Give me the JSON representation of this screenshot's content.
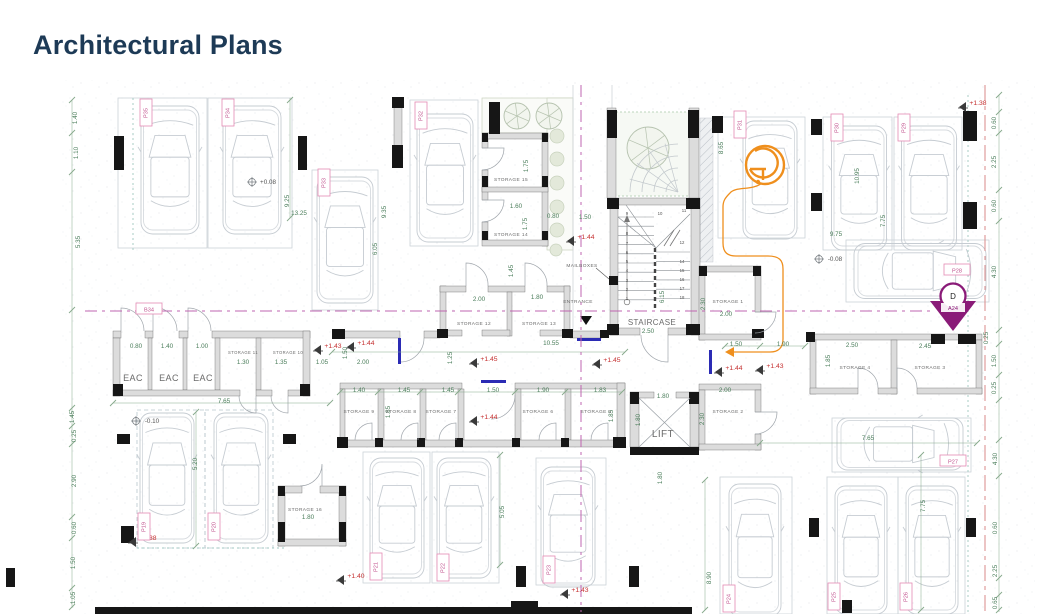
{
  "page": {
    "title": "Architectural Plans"
  },
  "colors": {
    "title": "#1d3a56",
    "dim": "#4a7d5a",
    "level": "#c53030",
    "spot": "#6f757a",
    "parking_border": "#e48ab4",
    "parking_text": "#c2548f",
    "wall_black": "#161616",
    "wall_gray": "#dcdcdc",
    "door": "#a0a6ac",
    "orange": "#ef8f1d",
    "marker_purple": "#8a1b78",
    "centerline": "#bf64b0",
    "boundary_red": "#d98a8a",
    "teal": "#9fc7c0",
    "blue_door": "#2b2bb4",
    "car": "#c6ccd2",
    "room_text": "#6a6a6a",
    "chain": "#86a98b"
  },
  "plan": {
    "rooms": [
      {
        "t": "STORAGE 15",
        "x": 511,
        "y": 181,
        "s": 4.8
      },
      {
        "t": "STORAGE 14",
        "x": 511,
        "y": 236,
        "s": 4.8
      },
      {
        "t": "STORAGE 13",
        "x": 539,
        "y": 325,
        "s": 4.8
      },
      {
        "t": "STORAGE 12",
        "x": 474,
        "y": 325,
        "s": 4.8
      },
      {
        "t": "STORAGE 11",
        "x": 243,
        "y": 354,
        "s": 4.2
      },
      {
        "t": "STORAGE 10",
        "x": 288,
        "y": 354,
        "s": 4.2
      },
      {
        "t": "STORAGE 9",
        "x": 359,
        "y": 413,
        "s": 4.8
      },
      {
        "t": "STORAGE 8",
        "x": 401,
        "y": 413,
        "s": 4.8
      },
      {
        "t": "STORAGE 7",
        "x": 441,
        "y": 413,
        "s": 4.8
      },
      {
        "t": "STORAGE 6",
        "x": 538,
        "y": 413,
        "s": 4.8
      },
      {
        "t": "STORAGE 5",
        "x": 596,
        "y": 413,
        "s": 4.8
      },
      {
        "t": "STORAGE 4",
        "x": 855,
        "y": 369,
        "s": 4.8
      },
      {
        "t": "STORAGE 3",
        "x": 930,
        "y": 369,
        "s": 4.8
      },
      {
        "t": "STORAGE 2",
        "x": 728,
        "y": 413,
        "s": 4.8
      },
      {
        "t": "STORAGE 1",
        "x": 728,
        "y": 303,
        "s": 4.8
      },
      {
        "t": "STORAGE 16",
        "x": 305,
        "y": 511,
        "s": 4.8
      },
      {
        "t": "EAC",
        "x": 133,
        "y": 381,
        "s": 9
      },
      {
        "t": "EAC",
        "x": 169,
        "y": 381,
        "s": 9
      },
      {
        "t": "EAC",
        "x": 203,
        "y": 381,
        "s": 9
      },
      {
        "t": "LIFT",
        "x": 663,
        "y": 437,
        "s": 10
      },
      {
        "t": "STAIRCASE",
        "x": 652,
        "y": 325,
        "s": 8
      },
      {
        "t": "ENTRANCE",
        "x": 578,
        "y": 303,
        "s": 4.8
      },
      {
        "t": "MAILBOXES",
        "x": 582,
        "y": 267,
        "s": 4.8
      }
    ],
    "dims": [
      {
        "t": "1.40",
        "x": 77,
        "y": 118,
        "v": 1
      },
      {
        "t": "1.10",
        "x": 78,
        "y": 153,
        "v": 1
      },
      {
        "t": "5.35",
        "x": 80,
        "y": 242,
        "v": 1
      },
      {
        "t": "1.45",
        "x": 74,
        "y": 417,
        "v": 1
      },
      {
        "t": "0.25",
        "x": 76,
        "y": 436,
        "v": 1
      },
      {
        "t": "2.90",
        "x": 76,
        "y": 481,
        "v": 1
      },
      {
        "t": "0.60",
        "x": 76,
        "y": 528,
        "v": 1
      },
      {
        "t": "1.50",
        "x": 75,
        "y": 563,
        "v": 1
      },
      {
        "t": "1.05",
        "x": 75,
        "y": 598,
        "v": 1
      },
      {
        "t": "9.25",
        "x": 289,
        "y": 201,
        "v": 1
      },
      {
        "t": "13.25",
        "x": 299,
        "y": 215,
        "v": 0
      },
      {
        "t": "9.35",
        "x": 386,
        "y": 212,
        "v": 1
      },
      {
        "t": "6.05",
        "x": 377,
        "y": 249,
        "v": 1
      },
      {
        "t": "8.65",
        "x": 723,
        "y": 148,
        "v": 1
      },
      {
        "t": "10.95",
        "x": 859,
        "y": 176,
        "v": 1
      },
      {
        "t": "7.75",
        "x": 885,
        "y": 221,
        "v": 1
      },
      {
        "t": "9.75",
        "x": 836,
        "y": 236,
        "v": 0
      },
      {
        "t": "2.00",
        "x": 363,
        "y": 364,
        "v": 0
      },
      {
        "t": "1.50",
        "x": 347,
        "y": 353,
        "v": 1
      },
      {
        "t": "1.25",
        "x": 452,
        "y": 358,
        "v": 1
      },
      {
        "t": "10.55",
        "x": 551,
        "y": 345,
        "v": 0
      },
      {
        "t": "1.50",
        "x": 736,
        "y": 346,
        "v": 0
      },
      {
        "t": "1.90",
        "x": 783,
        "y": 346,
        "v": 0
      },
      {
        "t": "1.40",
        "x": 359,
        "y": 392,
        "v": 0
      },
      {
        "t": "1.45",
        "x": 404,
        "y": 392,
        "v": 0
      },
      {
        "t": "1.45",
        "x": 448,
        "y": 392,
        "v": 0
      },
      {
        "t": "1.50",
        "x": 493,
        "y": 392,
        "v": 0
      },
      {
        "t": "1.90",
        "x": 543,
        "y": 392,
        "v": 0
      },
      {
        "t": "1.83",
        "x": 600,
        "y": 392,
        "v": 0
      },
      {
        "t": "1.85",
        "x": 390,
        "y": 412,
        "v": 1
      },
      {
        "t": "1.85",
        "x": 613,
        "y": 416,
        "v": 1
      },
      {
        "t": "0.80",
        "x": 136,
        "y": 348,
        "v": 0
      },
      {
        "t": "1.40",
        "x": 167,
        "y": 348,
        "v": 0
      },
      {
        "t": "1.00",
        "x": 202,
        "y": 348,
        "v": 0
      },
      {
        "t": "1.30",
        "x": 243,
        "y": 364,
        "v": 0
      },
      {
        "t": "1.35",
        "x": 281,
        "y": 364,
        "v": 0
      },
      {
        "t": "1.05",
        "x": 322,
        "y": 364,
        "v": 0
      },
      {
        "t": "7.65",
        "x": 224,
        "y": 403,
        "v": 0
      },
      {
        "t": "5.20",
        "x": 197,
        "y": 464,
        "v": 1
      },
      {
        "t": "1.75",
        "x": 528,
        "y": 166,
        "v": 1
      },
      {
        "t": "1.60",
        "x": 516,
        "y": 208,
        "v": 0
      },
      {
        "t": "1.75",
        "x": 527,
        "y": 224,
        "v": 1
      },
      {
        "t": "0.80",
        "x": 553,
        "y": 218,
        "v": 0
      },
      {
        "t": "1.50",
        "x": 585,
        "y": 219,
        "v": 0
      },
      {
        "t": "1.45",
        "x": 513,
        "y": 271,
        "v": 1
      },
      {
        "t": "1.80",
        "x": 537,
        "y": 299,
        "v": 0
      },
      {
        "t": "2.00",
        "x": 479,
        "y": 301,
        "v": 0
      },
      {
        "t": "2.00",
        "x": 726,
        "y": 316,
        "v": 0
      },
      {
        "t": "2.30",
        "x": 705,
        "y": 304,
        "v": 1
      },
      {
        "t": "2.00",
        "x": 725,
        "y": 392,
        "v": 0
      },
      {
        "t": "2.30",
        "x": 704,
        "y": 419,
        "v": 1
      },
      {
        "t": "1.80",
        "x": 663,
        "y": 398,
        "v": 0
      },
      {
        "t": "1.80",
        "x": 640,
        "y": 420,
        "v": 1
      },
      {
        "t": "1.80",
        "x": 662,
        "y": 478,
        "v": 1
      },
      {
        "t": "2.50",
        "x": 852,
        "y": 347,
        "v": 0
      },
      {
        "t": "1.85",
        "x": 830,
        "y": 361,
        "v": 1
      },
      {
        "t": "2.45",
        "x": 925,
        "y": 348,
        "v": 0
      },
      {
        "t": "2.50",
        "x": 648,
        "y": 333,
        "v": 0
      },
      {
        "t": "6.15",
        "x": 664,
        "y": 297,
        "v": 1
      },
      {
        "t": "1.80",
        "x": 308,
        "y": 519,
        "v": 0
      },
      {
        "t": "0.60",
        "x": 996,
        "y": 123,
        "v": 1
      },
      {
        "t": "2.25",
        "x": 996,
        "y": 162,
        "v": 1
      },
      {
        "t": "0.60",
        "x": 996,
        "y": 206,
        "v": 1
      },
      {
        "t": "4.30",
        "x": 996,
        "y": 272,
        "v": 1
      },
      {
        "t": "0.25",
        "x": 988,
        "y": 338,
        "v": 1
      },
      {
        "t": "1.50",
        "x": 996,
        "y": 361,
        "v": 1
      },
      {
        "t": "0.25",
        "x": 996,
        "y": 388,
        "v": 1
      },
      {
        "t": "4.30",
        "x": 997,
        "y": 459,
        "v": 1
      },
      {
        "t": "0.60",
        "x": 997,
        "y": 528,
        "v": 1
      },
      {
        "t": "2.25",
        "x": 997,
        "y": 571,
        "v": 1
      },
      {
        "t": "0.65",
        "x": 997,
        "y": 603,
        "v": 1
      },
      {
        "t": "7.65",
        "x": 868,
        "y": 440,
        "v": 0
      },
      {
        "t": "7.75",
        "x": 925,
        "y": 506,
        "v": 1
      },
      {
        "t": "8.90",
        "x": 711,
        "y": 578,
        "v": 1
      },
      {
        "t": "5.05",
        "x": 504,
        "y": 512,
        "v": 1
      }
    ],
    "levels": [
      {
        "t": "+1.44",
        "x": 366,
        "y": 345
      },
      {
        "t": "+1.43",
        "x": 333,
        "y": 348
      },
      {
        "t": "+1.45",
        "x": 489,
        "y": 361
      },
      {
        "t": "+1.45",
        "x": 612,
        "y": 362
      },
      {
        "t": "+1.44",
        "x": 489,
        "y": 419
      },
      {
        "t": "+1.44",
        "x": 586,
        "y": 239
      },
      {
        "t": "+1.44",
        "x": 734,
        "y": 370
      },
      {
        "t": "+1.43",
        "x": 775,
        "y": 368
      },
      {
        "t": "+1.38",
        "x": 978,
        "y": 105
      },
      {
        "t": "+1.38",
        "x": 148,
        "y": 540
      },
      {
        "t": "+1.40",
        "x": 356,
        "y": 578
      },
      {
        "t": "+1.43",
        "x": 580,
        "y": 592
      }
    ],
    "spot_levels": [
      {
        "t": "+0.08",
        "x": 268,
        "y": 184
      },
      {
        "t": "-0.10",
        "x": 152,
        "y": 423
      },
      {
        "t": "-0.08",
        "x": 835,
        "y": 261
      }
    ],
    "parking": [
      {
        "t": "P35",
        "x": 146,
        "y": 113,
        "h": 0
      },
      {
        "t": "P34",
        "x": 228,
        "y": 113,
        "h": 0
      },
      {
        "t": "P33",
        "x": 324,
        "y": 183,
        "h": 0
      },
      {
        "t": "P32",
        "x": 421,
        "y": 116,
        "h": 0
      },
      {
        "t": "P31",
        "x": 740,
        "y": 125,
        "h": 0
      },
      {
        "t": "P30",
        "x": 837,
        "y": 128,
        "h": 0
      },
      {
        "t": "P29",
        "x": 904,
        "y": 128,
        "h": 0
      },
      {
        "t": "P28",
        "x": 957,
        "y": 271,
        "h": 1
      },
      {
        "t": "P27",
        "x": 953,
        "y": 462,
        "h": 1
      },
      {
        "t": "P26",
        "x": 906,
        "y": 597,
        "h": 0
      },
      {
        "t": "P25",
        "x": 834,
        "y": 597,
        "h": 0
      },
      {
        "t": "P24",
        "x": 729,
        "y": 599,
        "h": 0
      },
      {
        "t": "P23",
        "x": 549,
        "y": 570,
        "h": 0
      },
      {
        "t": "P22",
        "x": 443,
        "y": 568,
        "h": 0
      },
      {
        "t": "P21",
        "x": 376,
        "y": 567,
        "h": 0
      },
      {
        "t": "P20",
        "x": 214,
        "y": 527,
        "h": 0
      },
      {
        "t": "P19",
        "x": 144,
        "y": 527,
        "h": 0
      },
      {
        "t": "B34",
        "x": 149,
        "y": 310,
        "h": 1
      }
    ],
    "stair_numbers": [
      {
        "t": "9",
        "x": 627,
        "y": 215
      },
      {
        "t": "8",
        "x": 627,
        "y": 235
      },
      {
        "t": "7",
        "x": 627,
        "y": 245
      },
      {
        "t": "6",
        "x": 627,
        "y": 254
      },
      {
        "t": "5",
        "x": 627,
        "y": 263
      },
      {
        "t": "4",
        "x": 627,
        "y": 272
      },
      {
        "t": "3",
        "x": 627,
        "y": 282
      },
      {
        "t": "2",
        "x": 627,
        "y": 291
      },
      {
        "t": "1",
        "x": 627,
        "y": 300
      },
      {
        "t": "10",
        "x": 660,
        "y": 215
      },
      {
        "t": "11",
        "x": 684,
        "y": 212
      },
      {
        "t": "12",
        "x": 682,
        "y": 244
      },
      {
        "t": "14",
        "x": 682,
        "y": 263
      },
      {
        "t": "15",
        "x": 682,
        "y": 272
      },
      {
        "t": "16",
        "x": 682,
        "y": 281
      },
      {
        "t": "17",
        "x": 682,
        "y": 290
      },
      {
        "t": "18",
        "x": 682,
        "y": 299
      }
    ],
    "marker": {
      "letter": "D",
      "code": "A24",
      "x": 953,
      "y": 312
    }
  }
}
